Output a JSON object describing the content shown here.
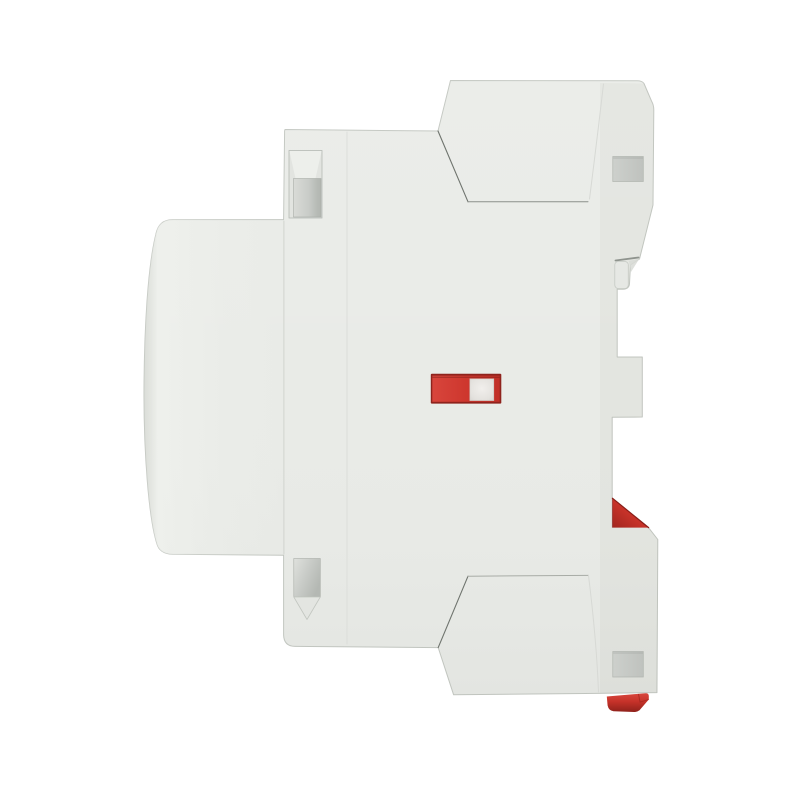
{
  "scene": {
    "type": "product-photo",
    "subject": "modular DIN-rail contactor, side profile view",
    "background_color": "#ffffff"
  },
  "device": {
    "body_color": "#e9ebe7",
    "edge_color": "#c3c7c1",
    "shade_color": "#30352f",
    "crease_dark": "#6f746e",
    "crease_medium": "#8b908a",
    "crease_light": "#d7d9d5",
    "seam_light": "#d1d4cf",
    "panel_line": "#dcdeda",
    "slot_outer": "#e2e4e0",
    "chamfer_light": "#edefeb",
    "chamfer_face": "#e3e5e1",
    "hole_border": "#aaaea8",
    "tab_color": "#e6e8e4",
    "tab_shadow": "#8f948e",
    "indicator": {
      "window_border": "#8f231d",
      "window_red": "#ce372e",
      "window_red_bright": "#d8453c",
      "window_red_deep": "#c12f27",
      "indicator_white": "#f1efec"
    },
    "clips": {
      "red_bright": "#d6423a",
      "red_mid": "#c63229",
      "red_dark": "#8f211b",
      "edge_dark": "#8a1f19"
    },
    "parts": [
      {
        "name": "front-bulge"
      },
      {
        "name": "front-slab"
      },
      {
        "name": "main-body"
      },
      {
        "name": "top-terminal-block"
      },
      {
        "name": "bottom-terminal-block"
      },
      {
        "name": "top-left-mounting-slot"
      },
      {
        "name": "bottom-left-mounting-slot"
      },
      {
        "name": "top-right-mounting-hole"
      },
      {
        "name": "bottom-right-mounting-hole"
      },
      {
        "name": "switch-indicator-window"
      },
      {
        "name": "switch-indicator-slider"
      },
      {
        "name": "din-rail-clip-tab"
      },
      {
        "name": "red-wedge-clip"
      },
      {
        "name": "red-bottom-clip"
      }
    ]
  }
}
